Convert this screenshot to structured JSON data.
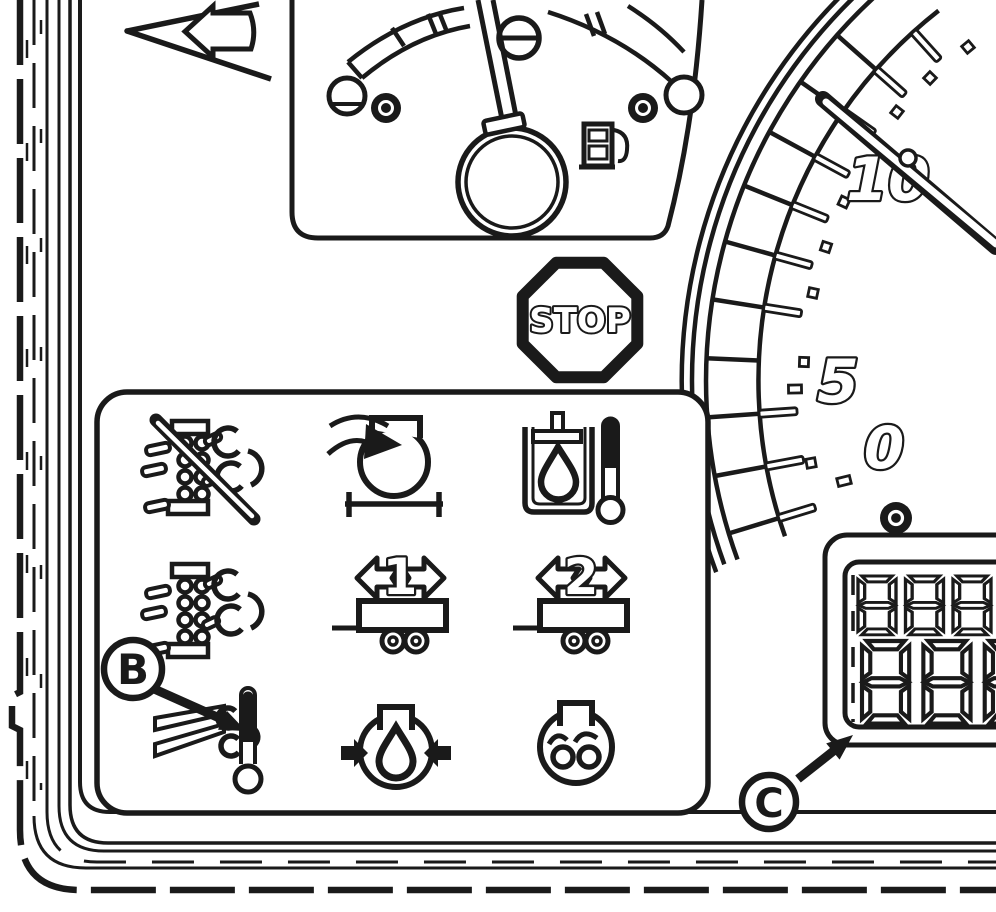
{
  "figure": {
    "name": "tractor-instrument-cluster-line-diagram",
    "colors": {
      "line": "#1a1a1a",
      "background": "#ffffff"
    }
  },
  "stop_sign": {
    "label": "STOP"
  },
  "tachometer": {
    "tick_labels": [
      "10",
      "5",
      "0"
    ]
  },
  "fuel_gauge": {
    "symbol": "fuel-pump-icon"
  },
  "lcd_display": {
    "rows": [
      {
        "digits": "888"
      },
      {
        "digits": "888"
      }
    ],
    "style": "seven-segment, all segments shown, rightmost bottom digit clipped by image edge"
  },
  "trailer_indicators": {
    "trailer1_number": "1",
    "trailer2_number": "2"
  },
  "callouts": {
    "b": {
      "label": "B",
      "points_to": "exhaust-temperature-icon"
    },
    "c": {
      "label": "C",
      "points_to": "lcd-odometer-display"
    }
  },
  "icon_legend": [
    "turn-signal-arrow-icon",
    "fuel-gauge",
    "fuel-pump-icon",
    "screw-slot-icon",
    "indicator-lamp-left-icon",
    "indicator-lamp-right-icon",
    "tachometer-dial",
    "tachometer-needle",
    "stop-sign",
    "air-filter-restriction-disabled-icon",
    "turbocharger-air-intake-icon",
    "transmission-oil-temperature-icon",
    "air-filter-restriction-icon",
    "trailer-1-turn-signal-icon",
    "trailer-2-turn-signal-icon",
    "exhaust-temperature-icon",
    "hydraulic-oil-pressure-icon",
    "engine-glow-plug-icon",
    "lcd-odometer-display",
    "callout-b",
    "callout-c"
  ]
}
